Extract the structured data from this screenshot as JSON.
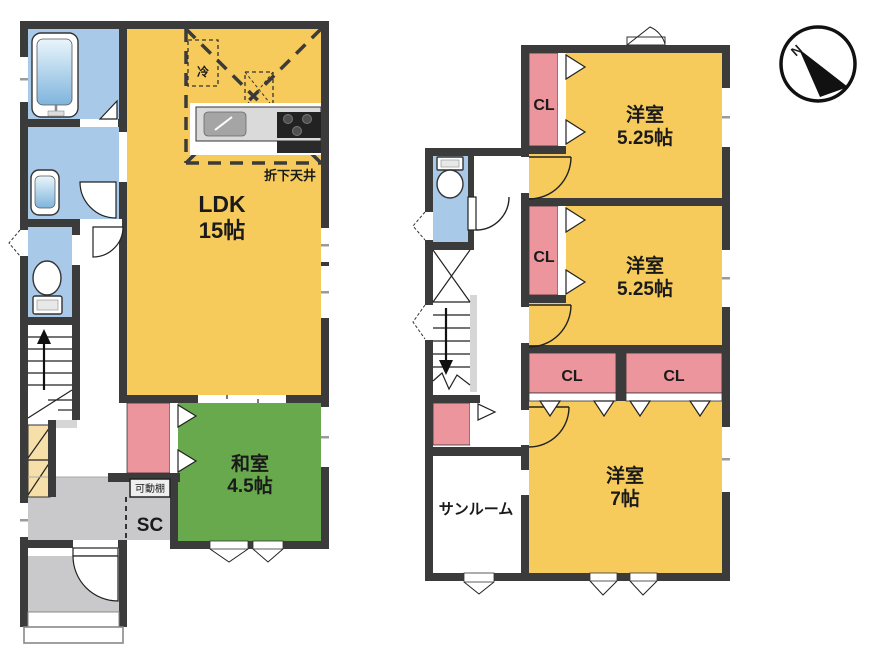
{
  "compass": {
    "north": "N"
  },
  "floor1": {
    "ldk": {
      "name": "LDK",
      "size": "15帖"
    },
    "washitsu": {
      "name": "和室",
      "size": "4.5帖"
    },
    "shoe_closet_label": "SC",
    "movable_shelf_label": "可動棚",
    "refrigerator_label": "冷",
    "dropped_ceiling_label": "折下天井"
  },
  "floor2": {
    "bedroom1": {
      "name": "洋室",
      "size": "5.25帖"
    },
    "bedroom2": {
      "name": "洋室",
      "size": "5.25帖"
    },
    "bedroom3": {
      "name": "洋室",
      "size": "7帖"
    },
    "sunroom_label": "サンルーム",
    "closets": {
      "cl1": "CL",
      "cl2": "CL",
      "cl3": "CL",
      "cl4": "CL"
    }
  },
  "colors": {
    "wall": "#3b3b3b",
    "room_yellow": "#f6cb5c",
    "tatami_green": "#68a94e",
    "closet_pink": "#ec959c",
    "wet_area_blue": "#a9c9e9",
    "entrance_gray": "#c9c9cb",
    "storage_cream": "#f7dfa9"
  }
}
